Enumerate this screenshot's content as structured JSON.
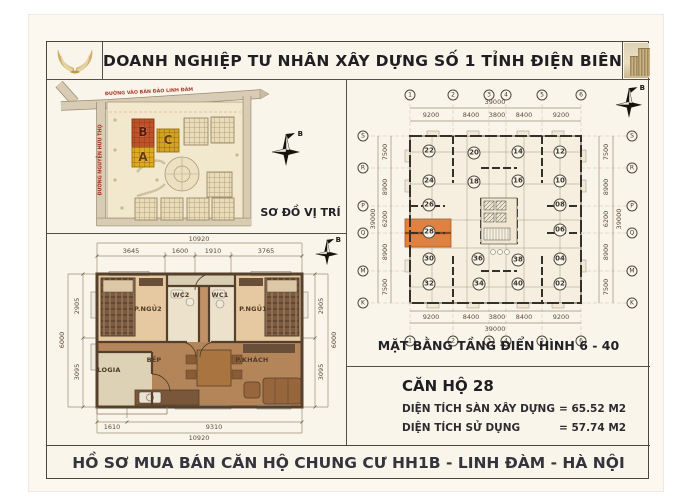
{
  "header": {
    "title": "DOANH NGHIỆP TƯ NHÂN XÂY DỰNG SỐ 1 TỈNH ĐIỆN BIÊN"
  },
  "footer": {
    "text": "HỒ SƠ MUA BÁN CĂN HỘ CHUNG CƯ HH1B - LINH ĐÀM - HÀ NỘI"
  },
  "site_map": {
    "caption": "SƠ ĐỒ VỊ TRÍ",
    "road_top": "ĐƯỜNG VÀO BÁN ĐẢO LINH ĐÀM",
    "road_left": "ĐƯỜNG NGUYỄN HỮU THỌ",
    "block_b": "B",
    "block_c": "C",
    "block_a": "A",
    "compass_label": "B",
    "colors": {
      "block_b": "#c05229",
      "block_c": "#d2a320",
      "block_a": "#ddab1e"
    }
  },
  "apartment_plan": {
    "compass_label": "B",
    "rooms": {
      "bedroom2": "P.NGỦ2",
      "wc2": "WC2",
      "wc1": "WC1",
      "bedroom1": "P.NGỦ1",
      "kitchen": "BẾP",
      "living": "P.KHÁCH",
      "loggia": "LOGIA"
    },
    "dims": {
      "top_total": "10920",
      "top": [
        "3645",
        "1600",
        "1910",
        "3765"
      ],
      "left": [
        "2905",
        "3095"
      ],
      "left_total": "6000",
      "right": [
        "2905",
        "3095"
      ],
      "right_total": "6000",
      "bottom": [
        "1610",
        "9310"
      ],
      "bottom_total": "10920"
    }
  },
  "building_plan": {
    "caption": "MẶT BẰNG TẦNG ĐIỂN HÌNH 6 - 40",
    "compass_label": "B",
    "grid_cols": [
      "1",
      "2",
      "3",
      "4",
      "5",
      "6"
    ],
    "grid_rows": [
      "S",
      "R",
      "P",
      "Q",
      "M",
      "K"
    ],
    "dims_h": [
      "9200",
      "8400",
      "3800",
      "8400",
      "9200"
    ],
    "dims_v": [
      "7500",
      "8900",
      "6200",
      "8900",
      "7500"
    ],
    "dim_total": "39000",
    "units": [
      "22",
      "20",
      "14",
      "12",
      "24",
      "18",
      "16",
      "10",
      "26",
      "08",
      "28",
      "06",
      "30",
      "36",
      "38",
      "04",
      "32",
      "34",
      "40",
      "02"
    ],
    "highlighted_unit": "28",
    "highlight_color": "#e08140"
  },
  "unit_info": {
    "title": "CĂN HỘ 28",
    "rows": [
      {
        "label": "DIỆN TÍCH SÀN XÂY DỰNG",
        "value": "= 65.52 M2"
      },
      {
        "label": "DIỆN TÍCH SỬ DỤNG",
        "value": "= 57.74 M2"
      }
    ]
  }
}
